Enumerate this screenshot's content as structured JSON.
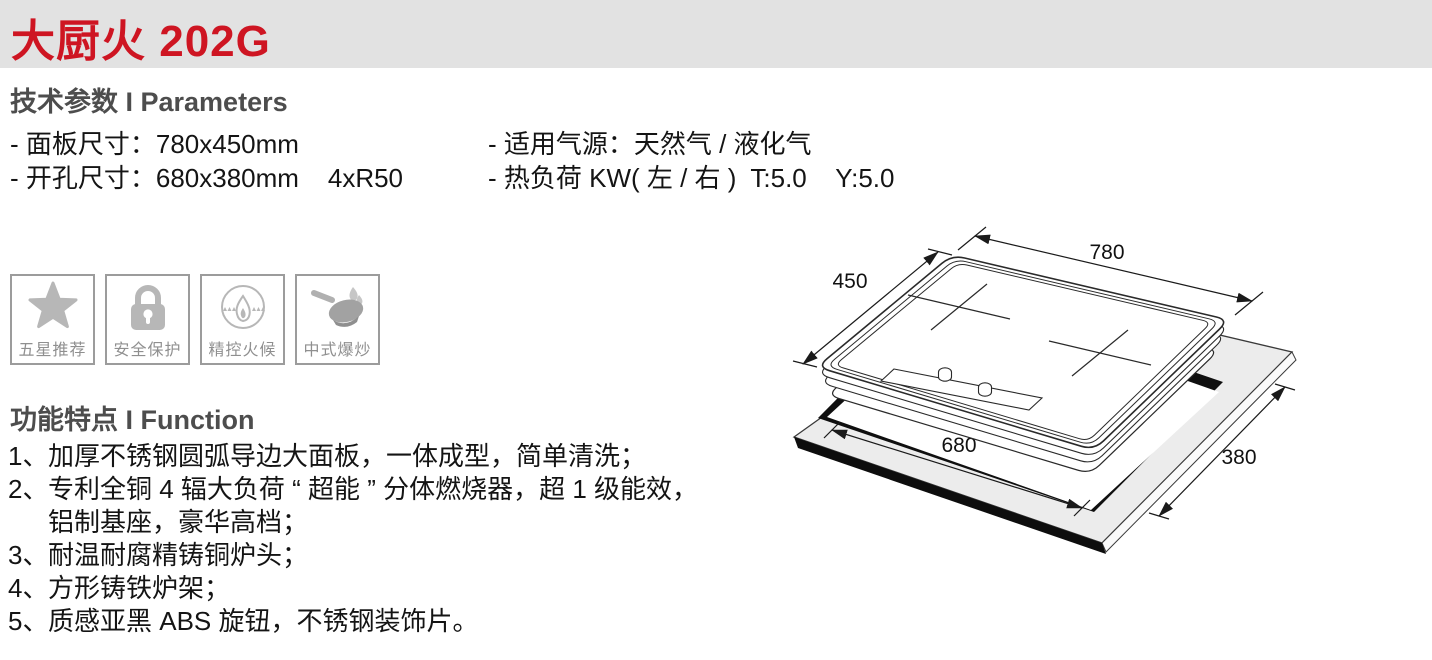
{
  "header": {
    "title": "大厨火 202G",
    "accent_color": "#ce1522",
    "band_color": "#e2e2e2"
  },
  "params": {
    "heading": "技术参数 I Parameters",
    "rows": [
      {
        "left": "- 面板尺寸：780x450mm",
        "right": "- 适用气源：天然气 / 液化气"
      },
      {
        "left": "- 开孔尺寸：680x380mm    4xR50",
        "right": "- 热负荷 KW( 左 / 右 )  T:5.0    Y:5.0"
      }
    ]
  },
  "badges": [
    {
      "icon": "star-icon",
      "label": "五星推荐"
    },
    {
      "icon": "lock-icon",
      "label": "安全保护"
    },
    {
      "icon": "flame-control-icon",
      "label": "精控火候"
    },
    {
      "icon": "wok-icon",
      "label": "中式爆炒"
    }
  ],
  "functions": {
    "heading": "功能特点 I Function",
    "items": [
      {
        "num": "1、",
        "lines": [
          "加厚不锈钢圆弧导边大面板，一体成型，简单清洗；"
        ]
      },
      {
        "num": "2、",
        "lines": [
          "专利全铜 4 辐大负荷 “ 超能 ” 分体燃烧器，超 1 级能效，",
          "铝制基座，豪华高档；"
        ]
      },
      {
        "num": "3、",
        "lines": [
          "耐温耐腐精铸铜炉头；"
        ]
      },
      {
        "num": "4、",
        "lines": [
          "方形铸铁炉架；"
        ]
      },
      {
        "num": "5、",
        "lines": [
          "质感亚黑 ABS 旋钮，不锈钢装饰片。"
        ]
      }
    ]
  },
  "diagram": {
    "panel_width_label": "780",
    "panel_depth_label": "450",
    "cutout_width_label": "680",
    "cutout_depth_label": "380"
  }
}
